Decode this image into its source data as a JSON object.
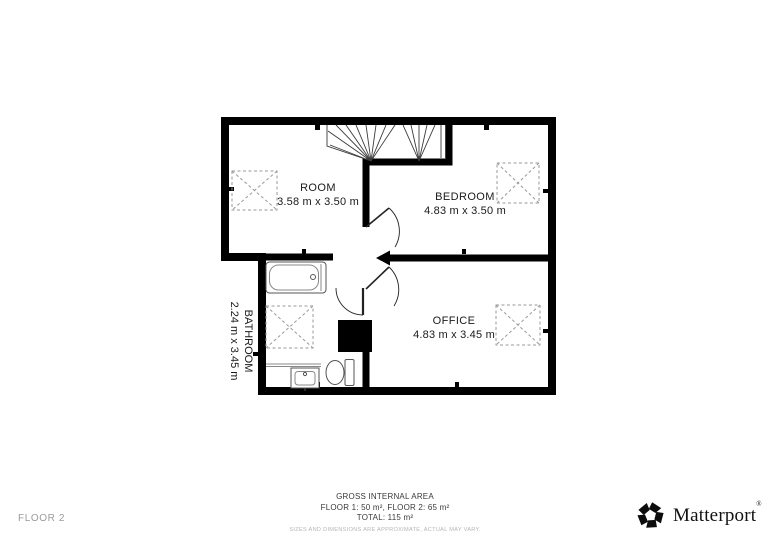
{
  "floorplan": {
    "floor_label": "FLOOR 2",
    "rooms": [
      {
        "name": "ROOM",
        "dimensions": "3.58 m x 3.50 m"
      },
      {
        "name": "BEDROOM",
        "dimensions": "4.83 m x 3.50 m"
      },
      {
        "name": "OFFICE",
        "dimensions": "4.83 m x 3.45 m"
      },
      {
        "name": "BATHROOM",
        "dimensions": "2.24 m x 3.45 m"
      }
    ],
    "fixtures": [
      "stairs",
      "bathtub",
      "sink",
      "toilet",
      "chimney"
    ],
    "skylight_count": 4,
    "door_count": 3
  },
  "summary": {
    "title": "GROSS INTERNAL AREA",
    "floors_line": "FLOOR 1: 50 m², FLOOR 2: 65 m²",
    "total_line": "TOTAL: 115 m²",
    "disclaimer": "SIZES AND DIMENSIONS ARE APPROXIMATE, ACTUAL MAY VARY."
  },
  "brand": {
    "name": "Matterport",
    "registered": "®"
  },
  "colors": {
    "background": "#ffffff",
    "walls": "#000000",
    "label_text": "#1a1a1a",
    "summary_text": "#3a3a3a",
    "muted_text": "#9b9b9b",
    "disclaimer_text": "#b5b5b5",
    "brand_text": "#111111"
  }
}
